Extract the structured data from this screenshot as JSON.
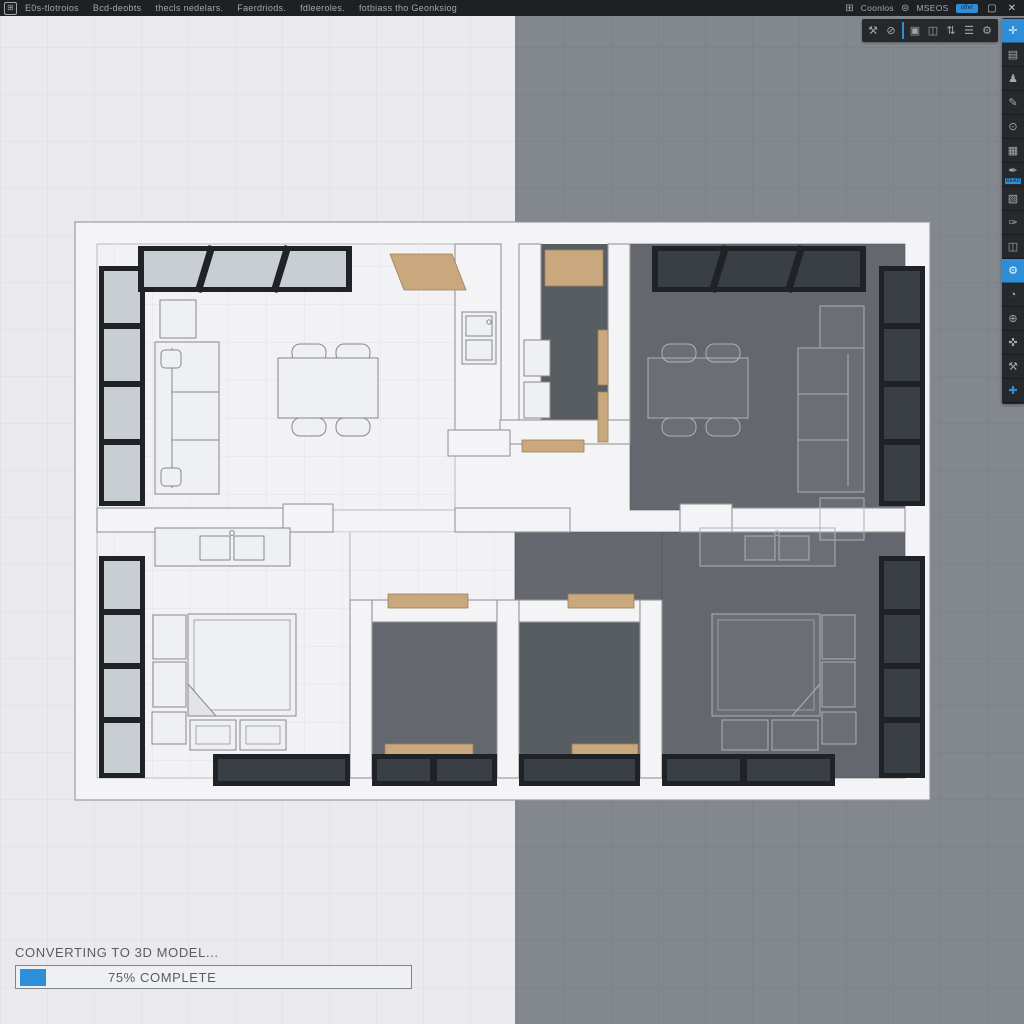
{
  "window": {
    "app_icon": "⊞",
    "menu_items": [
      "E0s-tlotroios",
      "Bcd-deobts",
      "thecls nedelars.",
      "Faerdriods.",
      "fdleeroles.",
      "fotbiass tho Geonksiog"
    ],
    "system": {
      "grid_icon": "⊞",
      "grid_label": "Coonlos",
      "help_icon": "⊜",
      "help_label": "MSEOS",
      "badge_label": "offet",
      "maximize_glyph": "▢",
      "close_glyph": "✕"
    }
  },
  "toolbar": {
    "icons": [
      {
        "name": "wrench-icon",
        "glyph": "⚒"
      },
      {
        "name": "disable-icon",
        "glyph": "⊘"
      },
      {
        "name": "select-icon",
        "glyph": "▣"
      },
      {
        "name": "window-icon",
        "glyph": "◫"
      },
      {
        "name": "swap-icon",
        "glyph": "⇅"
      },
      {
        "name": "list-icon",
        "glyph": "☰"
      },
      {
        "name": "gear-icon",
        "glyph": "⚙"
      }
    ]
  },
  "sidebar": {
    "mini_label": "READ",
    "icons": [
      {
        "name": "pan-icon",
        "glyph": "✛"
      },
      {
        "name": "document-icon",
        "glyph": "▤"
      },
      {
        "name": "person-icon",
        "glyph": "♟"
      },
      {
        "name": "pen-icon",
        "glyph": "✎"
      },
      {
        "name": "search-icon",
        "glyph": "⊙"
      },
      {
        "name": "grid-icon",
        "glyph": "▦"
      },
      {
        "name": "annotate-icon",
        "glyph": "✒"
      },
      {
        "name": "hatch-icon",
        "glyph": "▧"
      },
      {
        "name": "sign-icon",
        "glyph": "✑"
      },
      {
        "name": "panels-icon",
        "glyph": "◫"
      },
      {
        "name": "settings-icon",
        "glyph": "⚙"
      },
      {
        "name": "timer-icon",
        "glyph": "◔"
      },
      {
        "name": "add-icon",
        "glyph": "⊕"
      },
      {
        "name": "move-icon",
        "glyph": "✜"
      },
      {
        "name": "tools-icon",
        "glyph": "⚒"
      },
      {
        "name": "plus-icon",
        "glyph": "✚"
      }
    ]
  },
  "status": {
    "message": "CONVERTING TO 3D MODEL...",
    "progress_label": "75% COMPLETE",
    "progress_percent": 75
  },
  "colors": {
    "chrome": "#1e2024",
    "chromeItem": "#26282c",
    "icon": "#a3a7ad",
    "accent": "#2e8fd8",
    "bgLeft": "#e9e9ee",
    "bgRight": "#83878e",
    "gridLeft": "#dcdce1",
    "gridRight": "#7a7e85",
    "wall": "#f4f4f6",
    "wallStroke": "#96969c",
    "floorLight": "#f2f2f5",
    "tileLine": "#e2e2e7",
    "floorDark": "#64686e",
    "floorDarker": "#585d62",
    "frame": "#1f2226",
    "glassLight": "#c9ced3",
    "glassDark": "#3a3f45",
    "wood": "#c9a87e",
    "furn": "#eef0f2",
    "furnStroke": "#87878d",
    "wire": "#aeb2b7",
    "statusText": "#595d63",
    "barBorder": "#808389",
    "barBg": "#eef0f3"
  }
}
